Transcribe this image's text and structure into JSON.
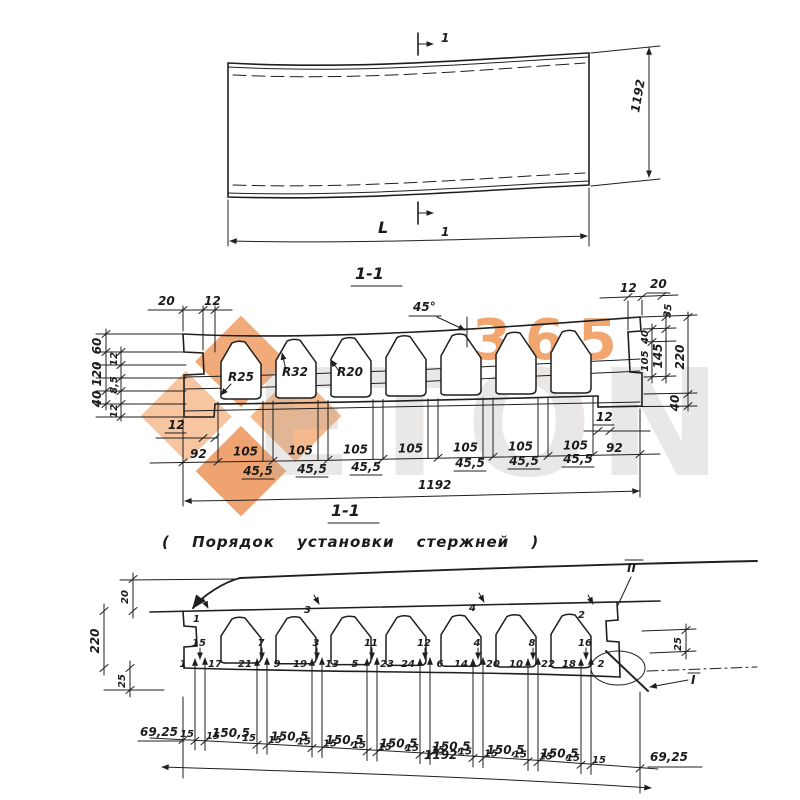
{
  "watermark": {
    "brand_text": "ETON",
    "brand_number": "365",
    "accent_color": "#f0914c",
    "gray_color": "#b5afa9"
  },
  "plan_view": {
    "section_mark": "1",
    "width_dim": "1192",
    "length_dim": "L"
  },
  "section_view": {
    "title": "1-1",
    "chamfer_angle": "45°",
    "radius_labels": [
      "R25",
      "R32",
      "R20"
    ],
    "top_left_dims": [
      "20",
      "12"
    ],
    "top_right_dims": [
      "12",
      "20"
    ],
    "left_outer_dims": [
      "60",
      "120",
      "40"
    ],
    "left_inner_dims": [
      "12",
      "8,5",
      "12"
    ],
    "left_bottom_dim": "12",
    "right_bottom_dim": "12",
    "right_dims": {
      "d35": "35",
      "d40_top": "40",
      "d105": "105",
      "d145": "145",
      "d220": "220",
      "d40_bottom": "40"
    },
    "end_dim": "92",
    "core_pitch_dim": "105",
    "web_dim": "45,5",
    "total_dim": "1192"
  },
  "placement_view": {
    "title": "1-1",
    "caption": "( Порядок установки стержней )",
    "left_dims": [
      "20",
      "220",
      "25"
    ],
    "right_dim": "25",
    "top_rod_mark": "II",
    "bottom_rod_mark": "I",
    "top_bar_numbers": [
      "1",
      "3",
      "4",
      "2"
    ],
    "web_bar_numbers": [
      "15",
      "7",
      "3",
      "11",
      "12",
      "4",
      "8",
      "16"
    ],
    "bottom_bar_pairs": [
      [
        "1",
        "17"
      ],
      [
        "21",
        "9"
      ],
      [
        "19",
        "13"
      ],
      [
        "5",
        "23"
      ],
      [
        "24",
        "6"
      ],
      [
        "14",
        "20"
      ],
      [
        "10",
        "22"
      ],
      [
        "18",
        "2"
      ]
    ],
    "offset_dim": "15",
    "spacing_dim": "150,5",
    "end_dim": "69,25",
    "total_dim": "1192"
  }
}
